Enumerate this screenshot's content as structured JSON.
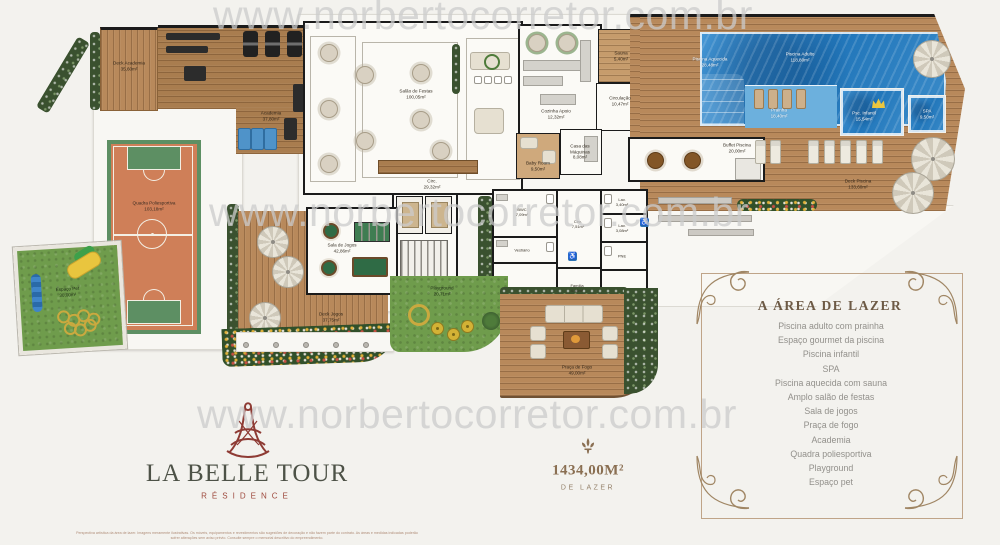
{
  "watermark": {
    "text": "www.norbertocorretor.com.br"
  },
  "plan": {
    "rooms": {
      "deck_academia": {
        "name": "Deck Academia",
        "area": "35,60m²"
      },
      "academia": {
        "name": "Academia",
        "area": "37,80m²"
      },
      "salao_festas": {
        "name": "Salão de Festas",
        "area": "100,05m²"
      },
      "circ_salao": {
        "name": "Circ.",
        "area": "29,32m²"
      },
      "cozinha_apoio": {
        "name": "Cozinha Apoio",
        "area": "12,32m²"
      },
      "sauna": {
        "name": "Sauna",
        "area": "5,40m²"
      },
      "circulacao": {
        "name": "Circulação",
        "area": "10,47m²"
      },
      "piscina_aquecida": {
        "name": "Piscina Aquecida",
        "area": "28,48m²"
      },
      "baby_room": {
        "name": "Baby Room",
        "area": "9,50m²"
      },
      "casa_maquinas": {
        "name": "Casa das Máquinas",
        "area": "8,08m²"
      },
      "piscina_adulto": {
        "name": "Piscina Adulto",
        "area": "118,80m²"
      },
      "prainha": {
        "name": "Prainha",
        "area": "18,40m²"
      },
      "psc_infantil": {
        "name": "Psc. Infantil",
        "area": "15,54m²"
      },
      "spa": {
        "name": "SPA",
        "area": "9,50m²"
      },
      "buffet_piscina": {
        "name": "Buffet Piscina",
        "area": "20,00m²"
      },
      "deck_piscina": {
        "name": "Deck Piscina",
        "area": "133,60m²"
      },
      "sala_jogos": {
        "name": "Sala de Jogos",
        "area": "42,86m²"
      },
      "deck_jogos": {
        "name": "Deck Jogos",
        "area": "37,75m²"
      },
      "playground": {
        "name": "Playground",
        "area": "20,71m²"
      },
      "praca_fogo": {
        "name": "Praça de Fogo",
        "area": "49,00m²"
      },
      "quadra": {
        "name": "Quadra Poliesportiva",
        "area": "103,18m²"
      },
      "espaco_pet": {
        "name": "Espaço Pet",
        "area": "30,00m²"
      },
      "circ_core": {
        "name": "Circ.",
        "area": "7,51m²"
      },
      "bwc": {
        "name": "BWC",
        "area": "7,09m²"
      },
      "vestiario": {
        "name": "Vestiário",
        "area": ""
      },
      "lav1": {
        "name": "Lav.",
        "area": "3,40m²"
      },
      "lav2": {
        "name": "Lav.",
        "area": "3,08m²"
      },
      "pne": {
        "name": "PNE",
        "area": ""
      },
      "familia": {
        "name": "Família",
        "area": "4,46m²"
      }
    }
  },
  "legend": {
    "title": "A ÁREA DE LAZER",
    "items": [
      "Piscina adulto com prainha",
      "Espaço gourmet da piscina",
      "Piscina infantil",
      "SPA",
      "Piscina aquecida com sauna",
      "Amplo salão de festas",
      "Sala de jogos",
      "Praça de fogo",
      "Academia",
      "Quadra poliesportiva",
      "Playground",
      "Espaço pet"
    ]
  },
  "summary": {
    "value": "1434,00M²",
    "label": "DE LAZER"
  },
  "branding": {
    "name": "LA BELLE TOUR",
    "subtitle": "RÉSIDENCE"
  },
  "disclaimer": "Perspectiva artística da área de lazer. Imagens meramente ilustrativas. Os móveis, equipamentos e revestimentos são sugestões de decoração e não fazem parte do contrato. As áreas e medidas indicadas poderão sofrer alterações sem aviso prévio. Consulte sempre o memorial descritivo do empreendimento.",
  "colors": {
    "accent_brown": "#8a6f52",
    "logo_red": "#8e3b34",
    "logo_green": "#4d5247",
    "pool_blue": "#2176ba",
    "court_orange": "#cf7f58",
    "grass_green": "#6f9c4c",
    "wood": "#b8895b"
  }
}
